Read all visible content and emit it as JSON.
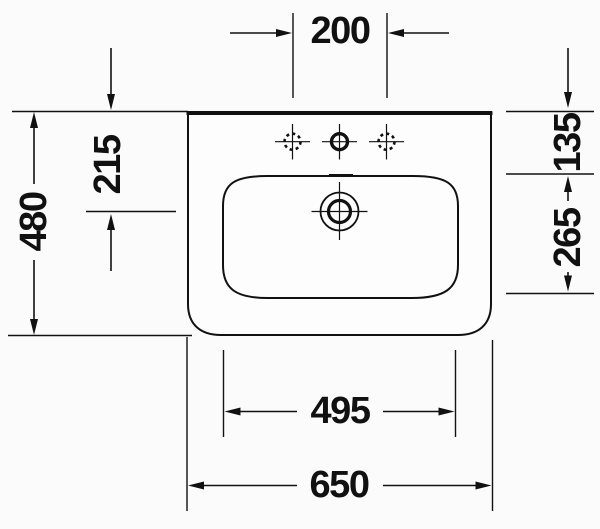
{
  "diagram": {
    "type": "technical-drawing",
    "subject": "Wall-mounted washbasin plan view with dimension lines",
    "unit": "mm",
    "colors": {
      "line": "#111111",
      "background": "#fbfbfb"
    },
    "features": {
      "tap_holes": "three tap holes on rear deck, outer two optional (dashed)",
      "drain": "central drain/overflow shown as double circle with crosshair"
    },
    "labels": {
      "tap_hole_spacing": "200",
      "back_edge_to_drain_center": "215",
      "overall_depth": "480",
      "back_edge_to_basin_inner_edge": "135",
      "basin_inner_depth": "265",
      "basin_inner_width": "495",
      "overall_width": "650"
    }
  }
}
